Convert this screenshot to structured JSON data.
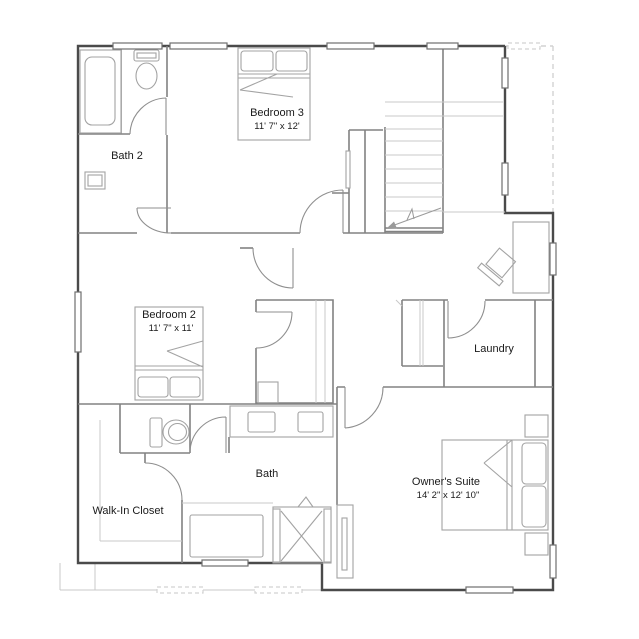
{
  "plan": {
    "rooms": {
      "bath2": {
        "label": "Bath 2"
      },
      "bedroom3": {
        "label": "Bedroom 3",
        "dims": "11' 7\" x 12'"
      },
      "bedroom2": {
        "label": "Bedroom 2",
        "dims": "11' 7\" x 11'"
      },
      "laundry": {
        "label": "Laundry"
      },
      "bath": {
        "label": "Bath"
      },
      "walk_in_closet": {
        "label": "Walk-In Closet"
      },
      "owners_suite": {
        "label": "Owner's Suite",
        "dims": "14' 2\" x 12' 10\""
      }
    },
    "colors": {
      "background": "#ffffff",
      "outer_wall": "#4a4a4a",
      "interior_wall": "#828282",
      "furniture": "#a3a3a3",
      "light_line": "#c9c9c9",
      "text": "#1a1a1a"
    }
  }
}
